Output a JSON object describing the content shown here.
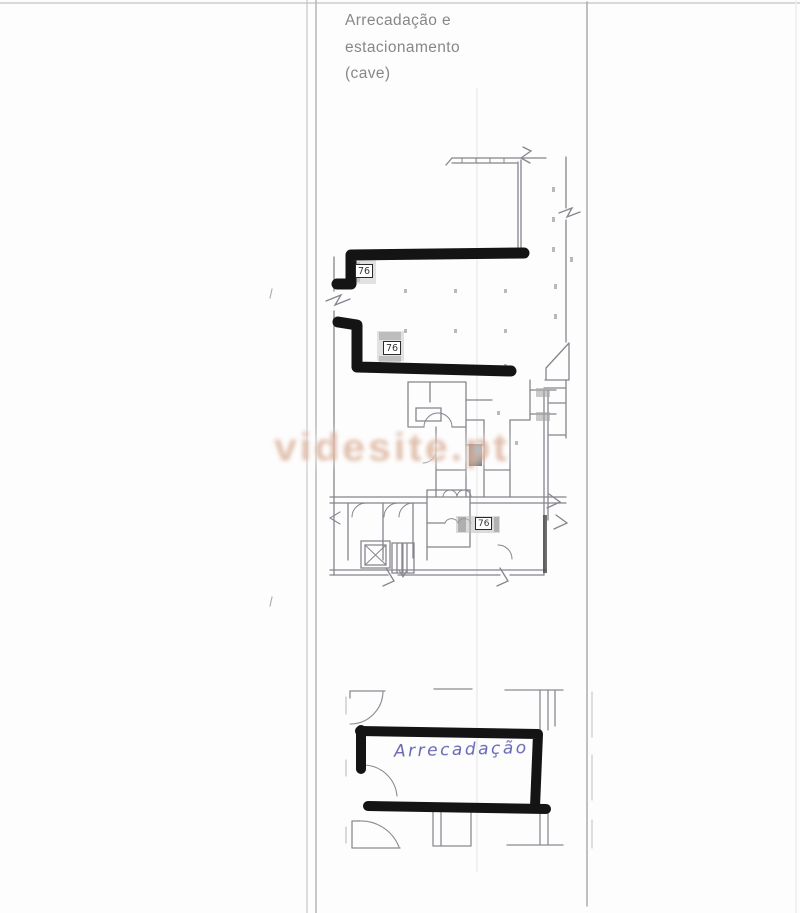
{
  "document": {
    "title_lines": [
      "Arrecadação e",
      "estacionamento",
      "(cave)"
    ],
    "title_color": "#878787"
  },
  "watermark": {
    "text": "videsite.pt",
    "color": "#c98f70"
  },
  "upper_plan": {
    "room_labels": [
      "76",
      "76",
      "76"
    ]
  },
  "lower_plan": {
    "handwritten_label": "Arrecadação",
    "ink_color": "#6868b4"
  },
  "annotations": {
    "marker_color": "#141414"
  },
  "colors": {
    "paper": "#fdfdfd",
    "plan_linework": "#85858d",
    "page_rules": "#b5b5b5"
  }
}
